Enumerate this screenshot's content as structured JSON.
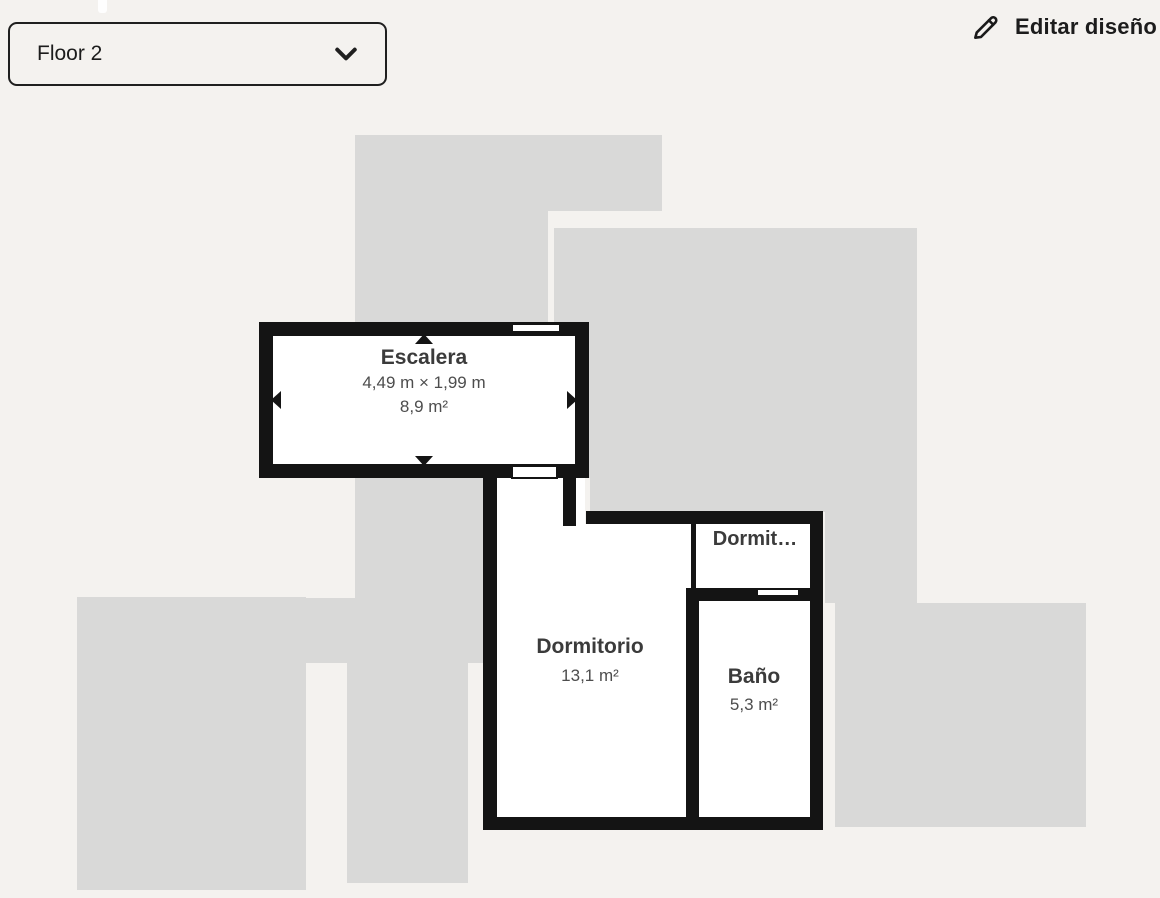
{
  "toolbar": {
    "floor_selector": {
      "value": "Floor 2",
      "icon": "chevron-down-icon"
    },
    "edit_button": {
      "label": "Editar diseño",
      "icon": "pencil-icon"
    }
  },
  "floor_plan": {
    "selected_room": {
      "name": "Escalera",
      "dimensions": "4,49 m × 1,99 m",
      "area": "8,9 m²"
    },
    "rooms": [
      {
        "name": "Dormitorio",
        "area": "13,1 m²"
      },
      {
        "name": "Dormit…",
        "area": ""
      },
      {
        "name": "Baño",
        "area": "5,3 m²"
      }
    ]
  },
  "colors": {
    "background": "#f4f2ef",
    "silhouette": "#d9d9d8",
    "wall": "#141414",
    "room_fill": "#ffffff",
    "title_text": "#3b3b3b",
    "dimension_text": "#4d4d4d",
    "toolbar_text": "#1c1c1c"
  }
}
